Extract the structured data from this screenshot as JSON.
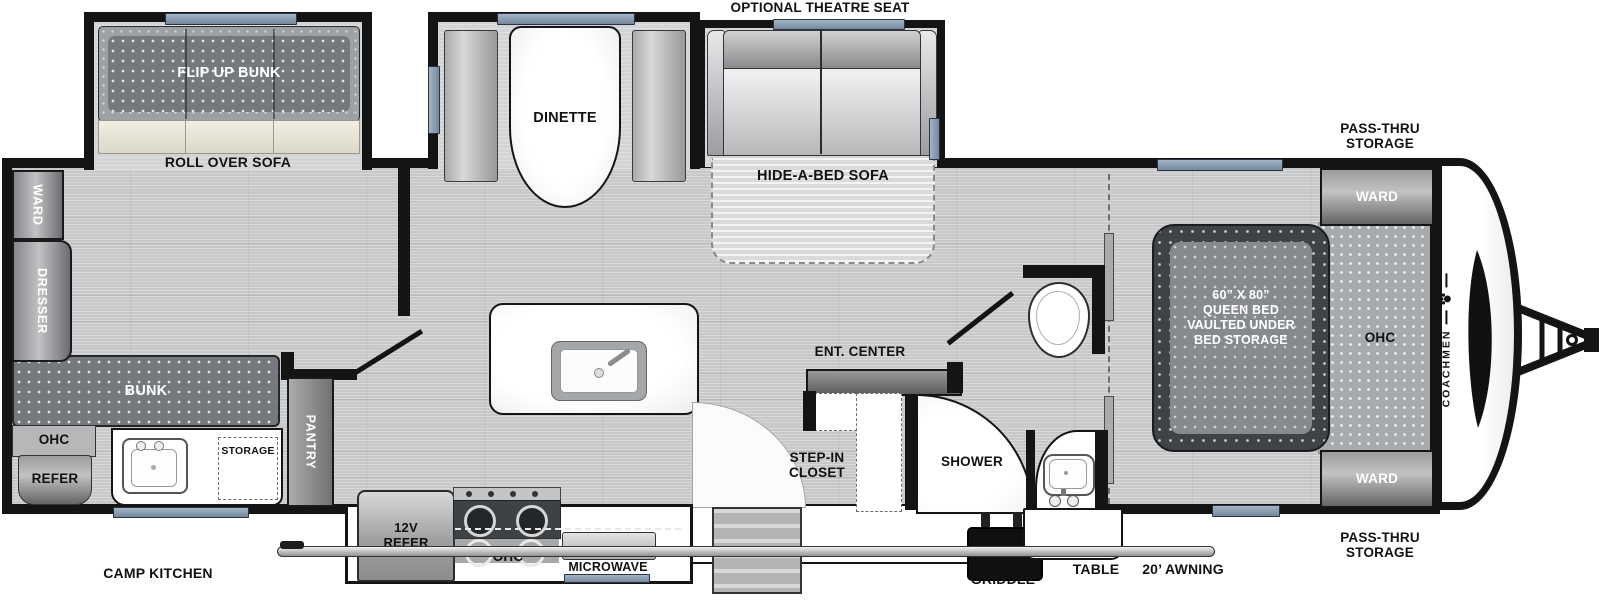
{
  "brand": "COACHMEN",
  "colors": {
    "wall": "#141414",
    "window": "#8a9bb0",
    "floor": "#c6c8ca",
    "bed_dark": "#3f4246",
    "griddle": "#101010"
  },
  "exterior": {
    "optional_theatre_seat": "OPTIONAL THEATRE SEAT",
    "pass_thru_storage_top": "PASS-THRU STORAGE",
    "pass_thru_storage_bottom": "PASS-THRU STORAGE",
    "camp_kitchen": "CAMP KITCHEN",
    "griddle": "GRIDDLE",
    "table": "TABLE",
    "awning": "20’ AWNING"
  },
  "bunk_room": {
    "flip_up_bunk": "FLIP UP BUNK",
    "roll_over_sofa": "ROLL OVER SOFA",
    "ward": "WARD",
    "dresser": "DRESSER",
    "bunk": "BUNK",
    "ohc": "OHC",
    "refer": "REFER",
    "storage": "STORAGE"
  },
  "kitchen": {
    "pantry": "PANTRY",
    "refer_12v": "12V REFER",
    "ohc": "OHC",
    "microwave": "MICROWAVE",
    "dinette": "DINETTE"
  },
  "living": {
    "hide_a_bed_sofa": "HIDE-A-BED SOFA",
    "ent_center": "ENT. CENTER"
  },
  "bath": {
    "step_in_closet": "STEP-IN CLOSET",
    "shower": "SHOWER"
  },
  "bedroom": {
    "bed_size": "60” X 80”",
    "bed_line2": "QUEEN BED",
    "bed_line3": "VAULTED UNDER",
    "bed_line4": "BED STORAGE",
    "ohc": "OHC",
    "ward_top": "WARD",
    "ward_bottom": "WARD"
  }
}
